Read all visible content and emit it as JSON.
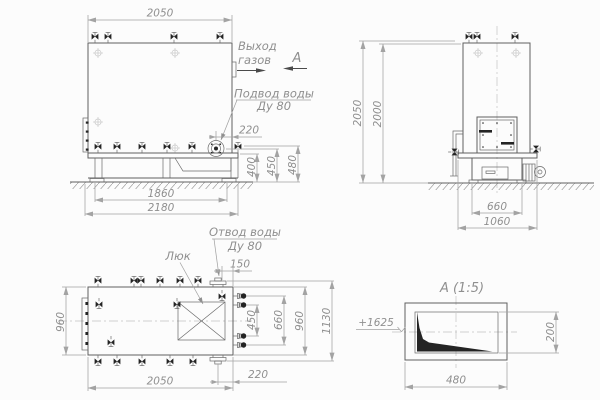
{
  "drawing": {
    "type": "boiler technical drawing, three views and detail",
    "colors": {
      "background": "#fcfcfc",
      "line": "#5f5f5f",
      "thin": "#6a6a6a",
      "dim": "#a3a3a3",
      "center": "#c2c2c2",
      "text": "#8f8f8f",
      "dark": "#242424"
    },
    "front": {
      "dim_width_top": "2050",
      "gas_outlet_line1": "Выход",
      "gas_outlet_line2": "газов",
      "section_mark": "А",
      "water_supply_line1": "Подвод воды",
      "water_supply_line2": "Ду 80",
      "dim_flange_offset": "220",
      "dim_h400": "400",
      "dim_h450": "450",
      "dim_h480": "480",
      "dim_base_inner": "1860",
      "dim_base_outer": "2180"
    },
    "side": {
      "dim_h_overall": "2050",
      "dim_h_body": "2000",
      "dim_furnace": "660",
      "dim_base": "1060"
    },
    "plan": {
      "water_outlet_line1": "Отвод воды",
      "water_outlet_line2": "Ду 80",
      "hatch_label": "Люк",
      "dim_flange": "150",
      "dim_width_left": "960",
      "dim_nozzle_inner": "450",
      "dim_nozzle_outer": "660",
      "dim_width_right": "960",
      "dim_overall": "1130",
      "dim_length": "2050",
      "dim_flange_end": "220"
    },
    "detail": {
      "title": "А  (1:5)",
      "level": "+1625",
      "dim_width": "480",
      "dim_height": "200"
    }
  }
}
